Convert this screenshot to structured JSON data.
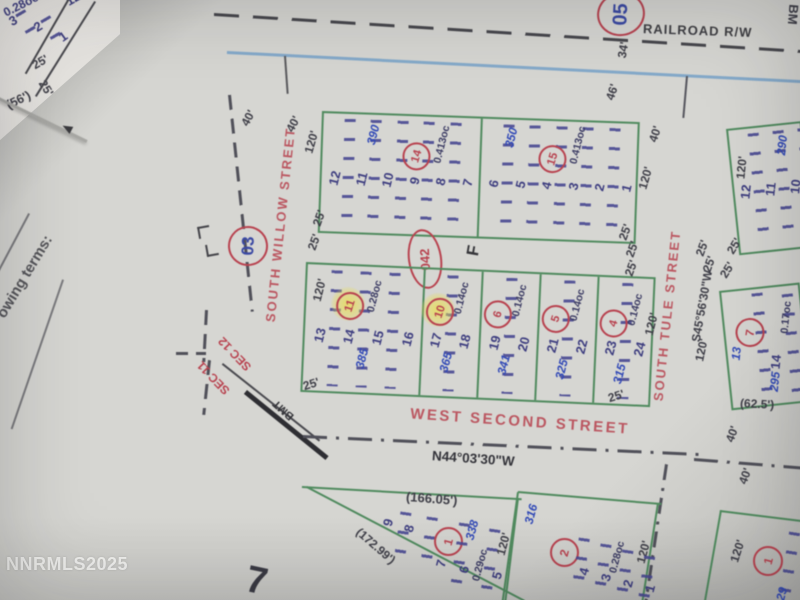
{
  "watermark": "NNRMLS2025",
  "misc": {
    "page_corner_number": "7",
    "left_margin_text": "owing terms:",
    "f_mark": "F",
    "bm_label": "BM",
    "bmt_label": "BMT"
  },
  "railroad": {
    "label": "RAILROAD R/W",
    "circle": "05"
  },
  "sec_line": {
    "upper": "SEC 12",
    "lower": "SEC 11"
  },
  "corner_block": {
    "area": "0.28oc.",
    "lots": [
      "3",
      "2",
      "1"
    ],
    "partial_lot": "12",
    "dims": [
      "25'",
      "25'",
      "(56')"
    ]
  },
  "willow": {
    "name": "SOUTH WILLOW STREET",
    "circle": "03"
  },
  "second_street": {
    "name": "WEST SECOND STREET",
    "bearing": "N44°03'30\"W"
  },
  "tule": {
    "name": "SOUTH TULE STREET",
    "bearing": "S45°56'30\"W"
  },
  "upper_block": {
    "circle_042": "042",
    "west": {
      "lots": [
        "12",
        "11",
        "10",
        "9",
        "8",
        "7"
      ],
      "address": "390",
      "circle": "14",
      "area": "0.413oc"
    },
    "east": {
      "lots": [
        "6",
        "5",
        "4",
        "3",
        "2",
        "1"
      ],
      "address": "350",
      "circle": "15",
      "area": "0.413oc"
    }
  },
  "middle_block": {
    "sections": [
      {
        "lots": [
          "13",
          "14",
          "15",
          "16"
        ],
        "circle": "11",
        "area": "0.28oc",
        "address": "385"
      },
      {
        "lots": [
          "17",
          "18"
        ],
        "circle": "10",
        "area": "0.14oc",
        "address": "365"
      },
      {
        "lots": [
          "19",
          "20"
        ],
        "circle": "6",
        "area": "0.14oc",
        "address": "341"
      },
      {
        "lots": [
          "21",
          "22"
        ],
        "circle": "5",
        "area": "0.14oc",
        "address": "325"
      },
      {
        "lots": [
          "23",
          "24"
        ],
        "circle": "4",
        "area": "0.14oc",
        "address": "315"
      }
    ]
  },
  "right_upper_block": {
    "lots": [
      "12",
      "11",
      "10"
    ],
    "address": "290",
    "dim_west": "120'"
  },
  "right_lower_block": {
    "circle": "7",
    "lots": [
      "13",
      "14"
    ],
    "address": "295",
    "area": "0.17oc",
    "dim_bottom": "(62.5')"
  },
  "bottom_left_block": {
    "dim_top": "(166.05')",
    "diag_dim": "(172.99')",
    "lots": [
      "9",
      "8",
      "7",
      "6",
      "5"
    ],
    "circle": "1",
    "address": "338",
    "area": "0.29oc",
    "dim_right": "120'"
  },
  "bottom_mid_block": {
    "address": "316",
    "circle": "2",
    "lots": [
      "4",
      "3",
      "2",
      "1"
    ],
    "area": "0.28oc",
    "dim_right": "120'"
  },
  "bottom_right_block": {
    "circle": "1",
    "dim_a": "40'",
    "dim_b": "40'",
    "dim_right": "120'",
    "address_partial": "29"
  },
  "ticks": [
    "25'",
    "25'",
    "25'",
    "25'",
    "25'",
    "25'",
    "25'",
    "25'",
    "120'",
    "40'",
    "40'",
    "46'",
    "40'",
    "120'",
    "34'",
    "120'",
    "120'",
    "25'",
    "25'",
    "120'",
    "25'"
  ]
}
